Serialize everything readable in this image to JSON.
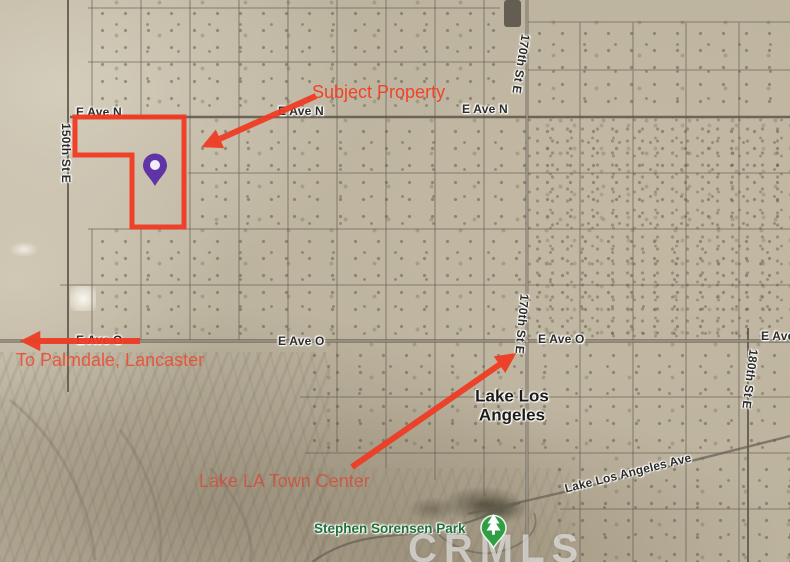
{
  "annotations": {
    "subject_property_label": "Subject Property",
    "to_palmdale_label": "To Palmdale, Lancaster",
    "town_center_label": "Lake LA Town Center",
    "accent_color": "#f13a22",
    "property_pin_color": "#5f35a5",
    "park_pin_color": "#2f9e44"
  },
  "place_labels": {
    "city": "Lake Los Angeles",
    "park": "Stephen Sorensen Park"
  },
  "street_labels": {
    "e_ave_n_west": "E Ave N",
    "e_ave_n_mid": "E Ave N",
    "e_ave_n_east": "E Ave N",
    "e_ave_o_under_arrow": "E Ave O",
    "e_ave_o_mid": "E Ave O",
    "e_ave_o_east": "E Ave O",
    "e_ave_edge": "E Ave",
    "st_150": "150th St E",
    "st_170_top": "170th St E",
    "st_170_mid": "170th St E",
    "st_180": "180th St E",
    "lake_la_ave": "Lake Los Angeles Ave"
  },
  "watermark": "CRMLS",
  "icons": {
    "property_pin": "map-pin",
    "park_pin": "tree-pin"
  }
}
